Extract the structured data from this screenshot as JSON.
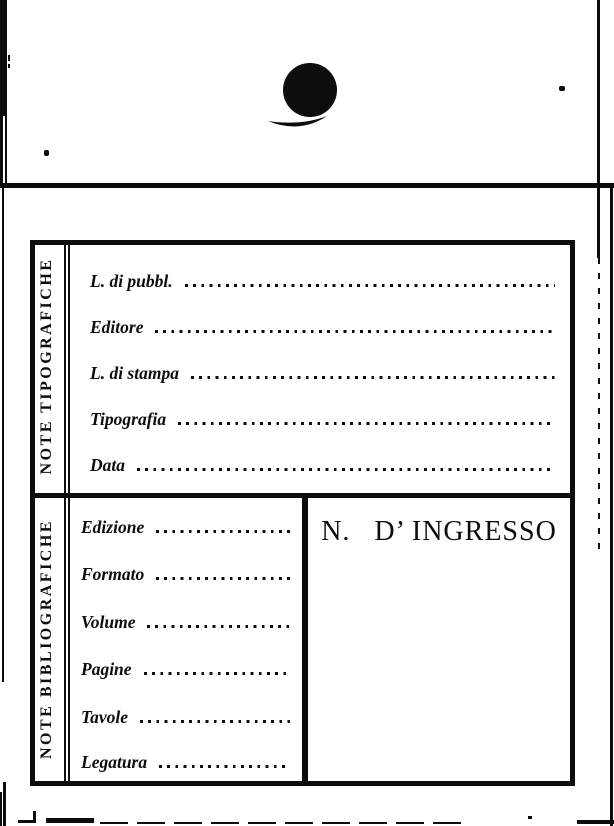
{
  "colors": {
    "paper": "#ffffff",
    "ink": "#0d0d0d"
  },
  "card": {
    "typographic": {
      "side_label": "NOTE TIPOGRAFICHE",
      "fields": [
        "L. di pubbl.",
        "Editore",
        "L. di stampa",
        "Tipografia",
        "Data"
      ]
    },
    "bibliographic": {
      "side_label": "NOTE BIBLIOGRAFICHE",
      "fields": [
        "Edizione",
        "Formato",
        "Volume",
        "Pagine",
        "Tavole",
        "Legatura"
      ],
      "ingresso_label": "N.   D’ INGRESSO"
    }
  }
}
